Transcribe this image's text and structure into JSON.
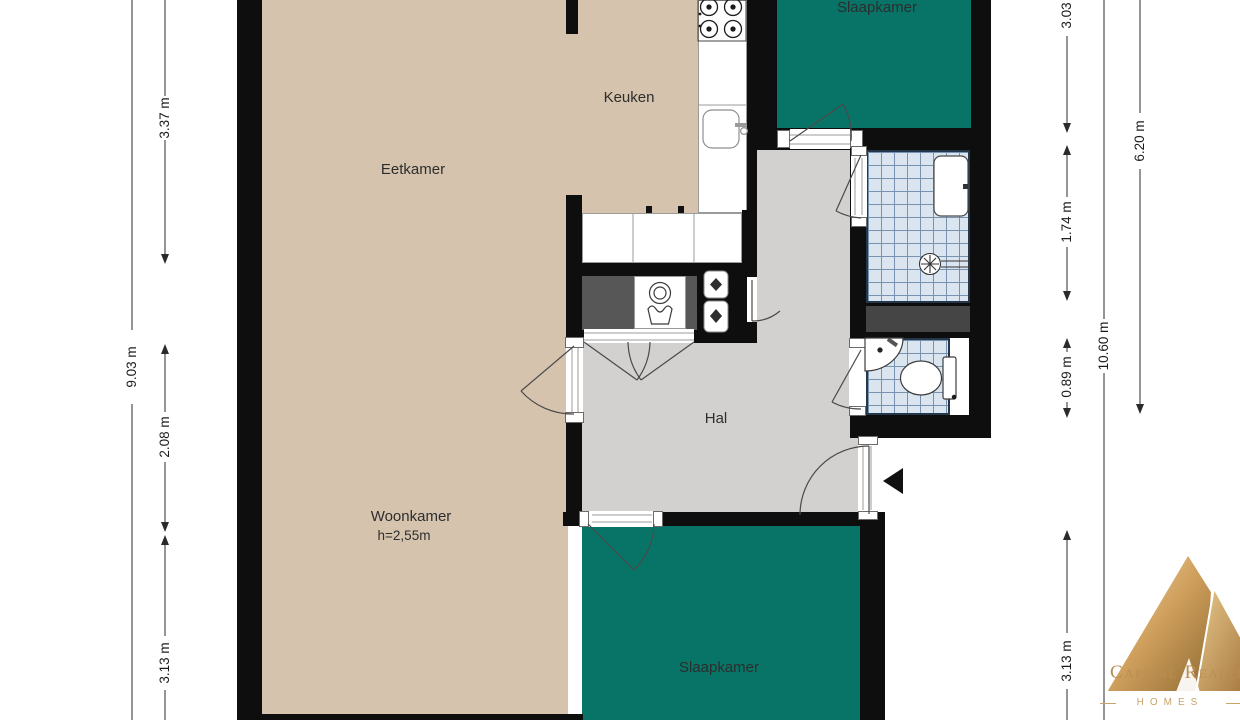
{
  "window": {
    "width": 1240,
    "height": 720,
    "background": "#ffffff"
  },
  "rooms": {
    "eetkamer": {
      "label": "Eetkamer"
    },
    "keuken": {
      "label": "Keuken"
    },
    "woonkamer": {
      "label": "Woonkamer",
      "ceiling_height": "h=2,55m"
    },
    "hal": {
      "label": "Hal"
    },
    "slaapkamer_top": {
      "label": "Slaapkamer"
    },
    "slaapkamer_bottom": {
      "label": "Slaapkamer"
    }
  },
  "dimensions": {
    "left": [
      {
        "label": "3.37 m"
      },
      {
        "label": "9.03 m"
      },
      {
        "label": "2.08 m"
      },
      {
        "label": "3.13 m"
      }
    ],
    "right": [
      {
        "label": "3.03 m"
      },
      {
        "label": "1.74 m"
      },
      {
        "label": "0.89 m"
      },
      {
        "label": "10.60 m"
      },
      {
        "label": "6.20 m"
      },
      {
        "label": "3.13 m"
      }
    ]
  },
  "logo": {
    "brand": "Capital Realti",
    "tagline": "HOMES"
  },
  "icons": [
    "stove-icon",
    "sink-icon",
    "washing-machine-icon",
    "laundry-tub-icon",
    "boiler-icon",
    "shower-drain-icon",
    "washbasin-icon",
    "toilet-icon",
    "corner-basin-icon",
    "entrance-arrow-icon",
    "mountain-logo-icon"
  ],
  "colors": {
    "floor_beige": "#d5c3ae",
    "room_teal": "#077467",
    "hall_gray": "#d2d1cf",
    "closet_gray": "#575757",
    "tile_blue": "#dae5ef",
    "tile_line": "#7793b0",
    "wall_black": "#0e0e0e",
    "logo_gold": "#b98e53",
    "dimension_text": "#1c1c1c"
  }
}
